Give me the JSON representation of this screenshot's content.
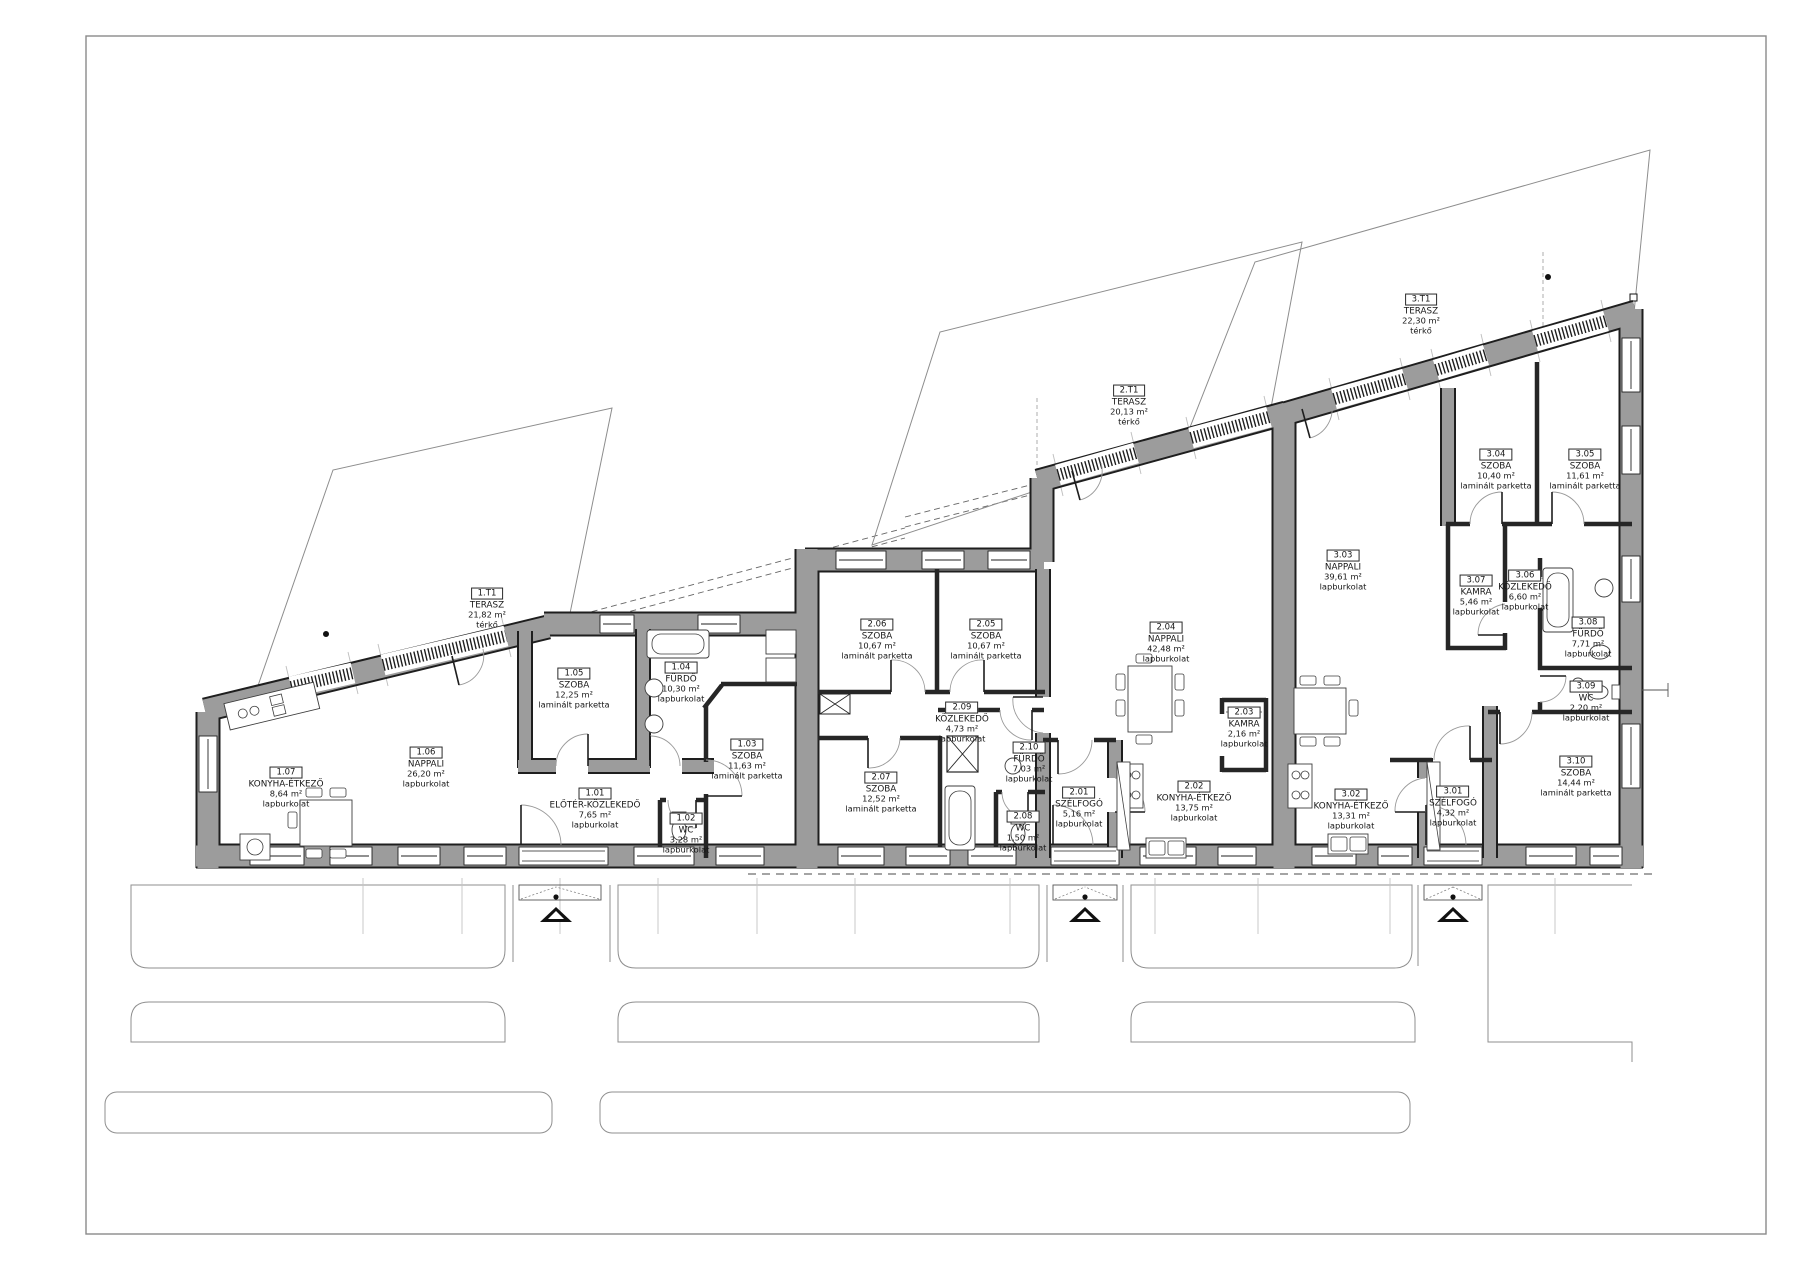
{
  "drawing": {
    "kind": "architectural floor plan",
    "language": "hu",
    "wall_color": "#9c9c9c",
    "line_color": "#1e1e1e"
  },
  "rooms": [
    {
      "id": "1.01",
      "name": "ELŐTÉR-KÖZLEKEDŐ",
      "area": "7,65 m²",
      "floor": "lapburkolat",
      "x": 595,
      "y": 807
    },
    {
      "id": "1.02",
      "name": "WC",
      "area": "3,28 m²",
      "floor": "lapburkolat",
      "x": 686,
      "y": 832
    },
    {
      "id": "1.03",
      "name": "SZOBA",
      "area": "11,63 m²",
      "floor": "laminált parketta",
      "x": 747,
      "y": 758
    },
    {
      "id": "1.04",
      "name": "FÜRDŐ",
      "area": "10,30 m²",
      "floor": "lapburkolat",
      "x": 681,
      "y": 681
    },
    {
      "id": "1.05",
      "name": "SZOBA",
      "area": "12,25 m²",
      "floor": "laminált parketta",
      "x": 574,
      "y": 687
    },
    {
      "id": "1.06",
      "name": "NAPPALI",
      "area": "26,20 m²",
      "floor": "lapburkolat",
      "x": 426,
      "y": 766
    },
    {
      "id": "1.07",
      "name": "KONYHA-ÉTKEZŐ",
      "area": "8,64 m²",
      "floor": "lapburkolat",
      "x": 286,
      "y": 786
    },
    {
      "id": "1.T1",
      "name": "TERASZ",
      "area": "21,82 m²",
      "floor": "térkő",
      "x": 487,
      "y": 607
    },
    {
      "id": "2.01",
      "name": "SZÉLFOGÓ",
      "area": "5,16 m²",
      "floor": "lapburkolat",
      "x": 1079,
      "y": 806
    },
    {
      "id": "2.02",
      "name": "KONYHA-ÉTKEZŐ",
      "area": "13,75 m²",
      "floor": "lapburkolat",
      "x": 1194,
      "y": 800
    },
    {
      "id": "2.03",
      "name": "KAMRA",
      "area": "2,16 m²",
      "floor": "lapburkolat",
      "x": 1244,
      "y": 726
    },
    {
      "id": "2.04",
      "name": "NAPPALI",
      "area": "42,48 m²",
      "floor": "lapburkolat",
      "x": 1166,
      "y": 641
    },
    {
      "id": "2.05",
      "name": "SZOBA",
      "area": "10,67 m²",
      "floor": "laminált parketta",
      "x": 986,
      "y": 638
    },
    {
      "id": "2.06",
      "name": "SZOBA",
      "area": "10,67 m²",
      "floor": "laminált parketta",
      "x": 877,
      "y": 638
    },
    {
      "id": "2.07",
      "name": "SZOBA",
      "area": "12,52 m²",
      "floor": "laminált parketta",
      "x": 881,
      "y": 791
    },
    {
      "id": "2.08",
      "name": "WC",
      "area": "1,50 m²",
      "floor": "lapburkolat",
      "x": 1023,
      "y": 830
    },
    {
      "id": "2.09",
      "name": "KÖZLEKEDŐ",
      "area": "4,73 m²",
      "floor": "lapburkolat",
      "x": 962,
      "y": 721
    },
    {
      "id": "2.10",
      "name": "FÜRDŐ",
      "area": "7,03 m²",
      "floor": "lapburkolat",
      "x": 1029,
      "y": 761
    },
    {
      "id": "2.T1",
      "name": "TERASZ",
      "area": "20,13 m²",
      "floor": "térkő",
      "x": 1129,
      "y": 404
    },
    {
      "id": "3.01",
      "name": "SZÉLFOGÓ",
      "area": "4,32 m²",
      "floor": "lapburkolat",
      "x": 1453,
      "y": 805
    },
    {
      "id": "3.02",
      "name": "KONYHA-ÉTKEZŐ",
      "area": "13,31 m²",
      "floor": "lapburkolat",
      "x": 1351,
      "y": 808
    },
    {
      "id": "3.03",
      "name": "NAPPALI",
      "area": "39,61 m²",
      "floor": "lapburkolat",
      "x": 1343,
      "y": 569
    },
    {
      "id": "3.04",
      "name": "SZOBA",
      "area": "10,40 m²",
      "floor": "laminált parketta",
      "x": 1496,
      "y": 468
    },
    {
      "id": "3.05",
      "name": "SZOBA",
      "area": "11,61 m²",
      "floor": "laminált parketta",
      "x": 1585,
      "y": 468
    },
    {
      "id": "3.06",
      "name": "KÖZLEKEDŐ",
      "area": "6,60 m²",
      "floor": "lapburkolat",
      "x": 1525,
      "y": 589
    },
    {
      "id": "3.07",
      "name": "KAMRA",
      "area": "5,46 m²",
      "floor": "lapburkolat",
      "x": 1476,
      "y": 594
    },
    {
      "id": "3.08",
      "name": "FÜRDŐ",
      "area": "7,71 m²",
      "floor": "lapburkolat",
      "x": 1588,
      "y": 636
    },
    {
      "id": "3.09",
      "name": "WC",
      "area": "2,20 m²",
      "floor": "lapburkolat",
      "x": 1586,
      "y": 700
    },
    {
      "id": "3.10",
      "name": "SZOBA",
      "area": "14,44 m²",
      "floor": "laminált parketta",
      "x": 1576,
      "y": 775
    },
    {
      "id": "3.T1",
      "name": "TERASZ",
      "area": "22,30 m²",
      "floor": "térkő",
      "x": 1421,
      "y": 313
    }
  ]
}
